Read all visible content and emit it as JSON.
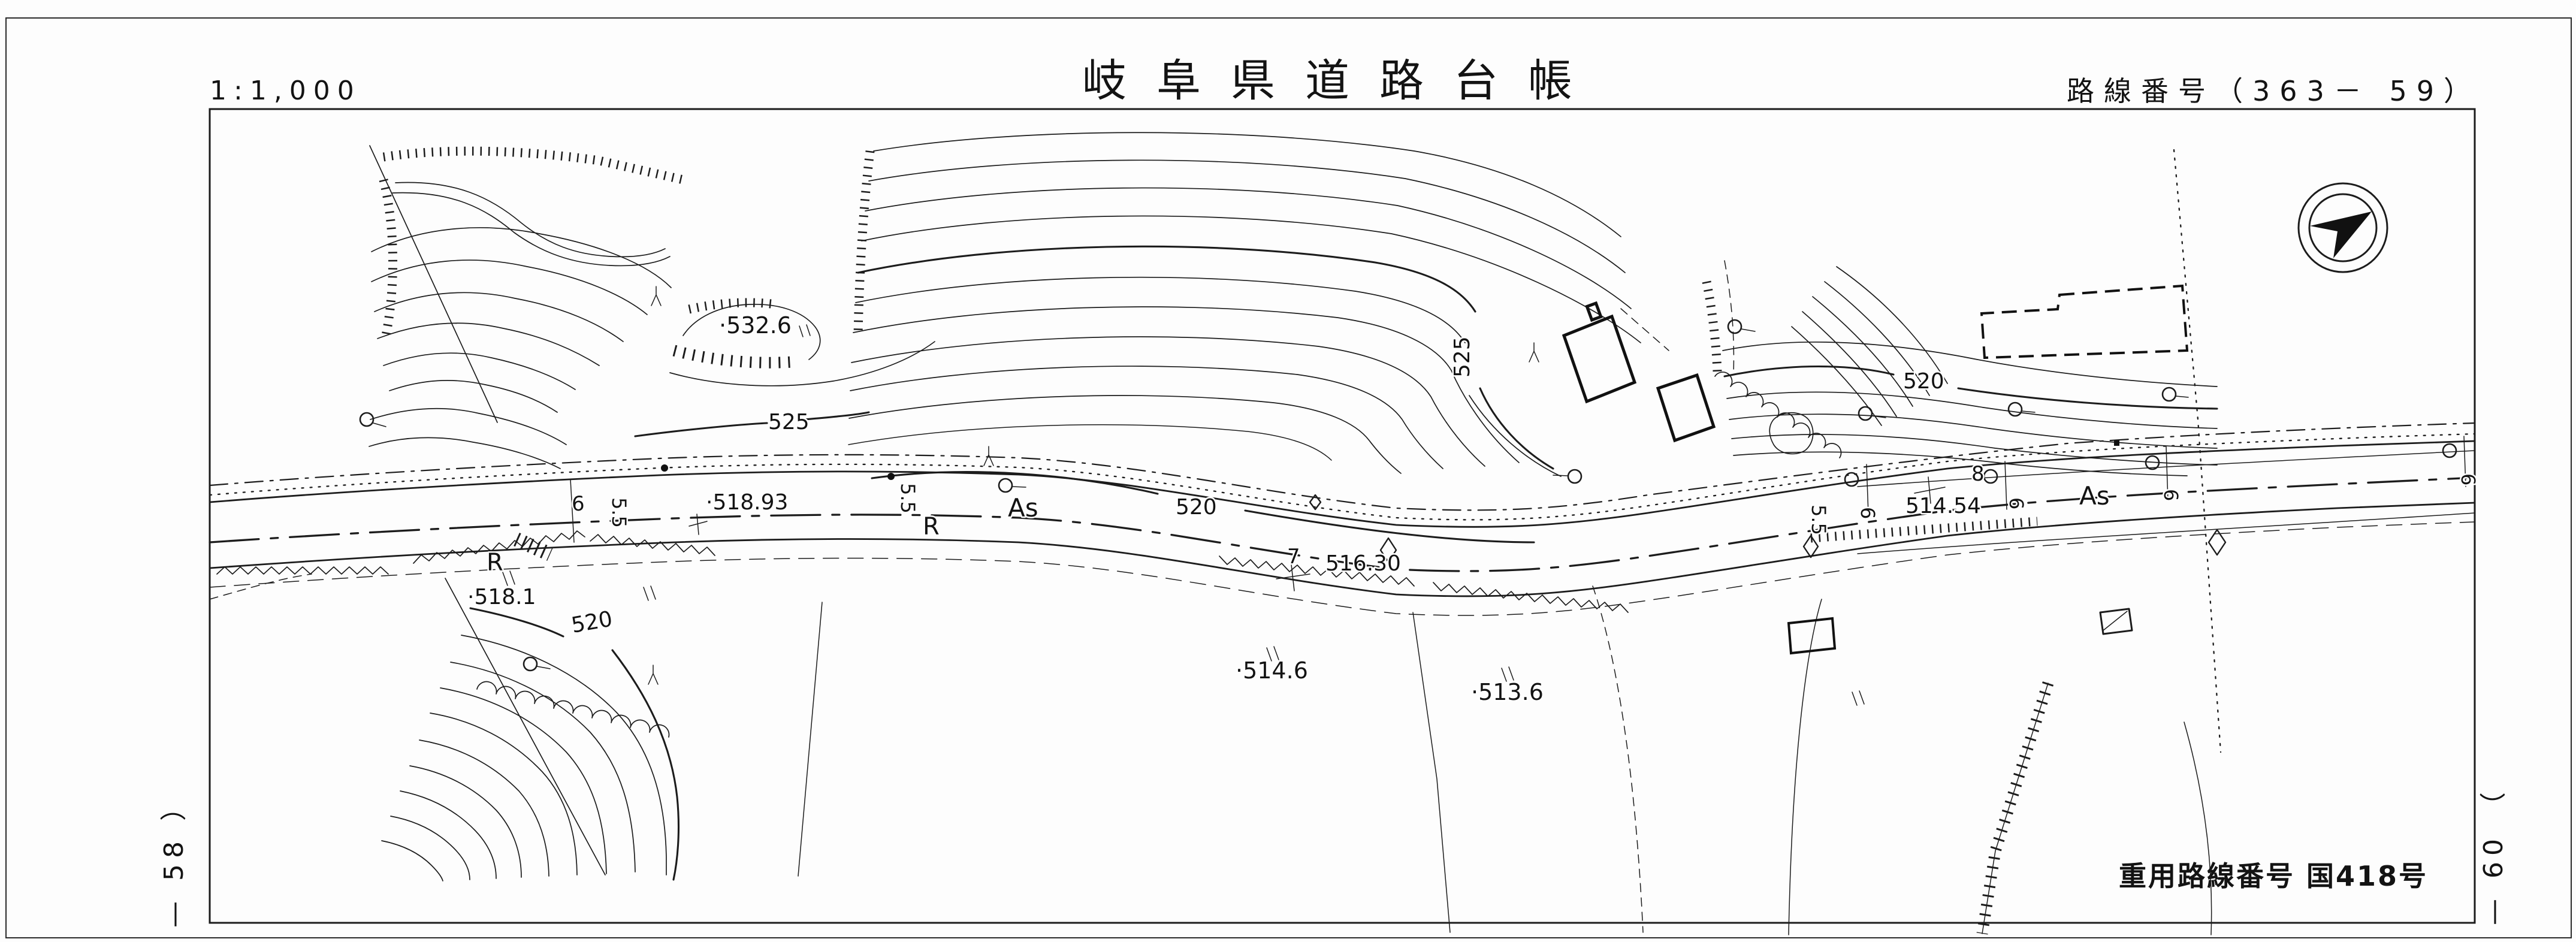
{
  "page": {
    "scale": "1:1,000",
    "title": "岐阜県道路台帳",
    "route_number": "路線番号（363－ 59）"
  },
  "footer": {
    "joint_route": "重用路線番号 国418号"
  },
  "edge_labels": {
    "left_sheet": "— 58 ）",
    "right_sheet": "— 60 （"
  },
  "icons": {
    "north_arrow": "compass-north-arrow"
  },
  "map": {
    "contour_labels": [
      {
        "text": "525"
      },
      {
        "text": "525"
      },
      {
        "text": "520"
      },
      {
        "text": "520"
      },
      {
        "text": "520"
      }
    ],
    "spot_elevations": [
      {
        "text": "·532.6"
      },
      {
        "text": "·518.1"
      },
      {
        "text": "·514.6"
      },
      {
        "text": "·513.6"
      }
    ],
    "stations": [
      {
        "text": "·518.93"
      },
      {
        "text": "516.30"
      },
      {
        "text": "514.54"
      }
    ],
    "station_numbers": [
      {
        "text": "7"
      },
      {
        "text": "8"
      }
    ],
    "surface": [
      {
        "text": "As"
      },
      {
        "text": "As"
      }
    ],
    "curve_points": [
      {
        "text": "R"
      },
      {
        "text": "R"
      }
    ],
    "widths": [
      {
        "text": "6"
      },
      {
        "text": "5.5"
      },
      {
        "text": "5.5"
      },
      {
        "text": "5.5"
      },
      {
        "text": "6"
      },
      {
        "text": "6"
      },
      {
        "text": "6"
      },
      {
        "text": "6"
      }
    ]
  }
}
